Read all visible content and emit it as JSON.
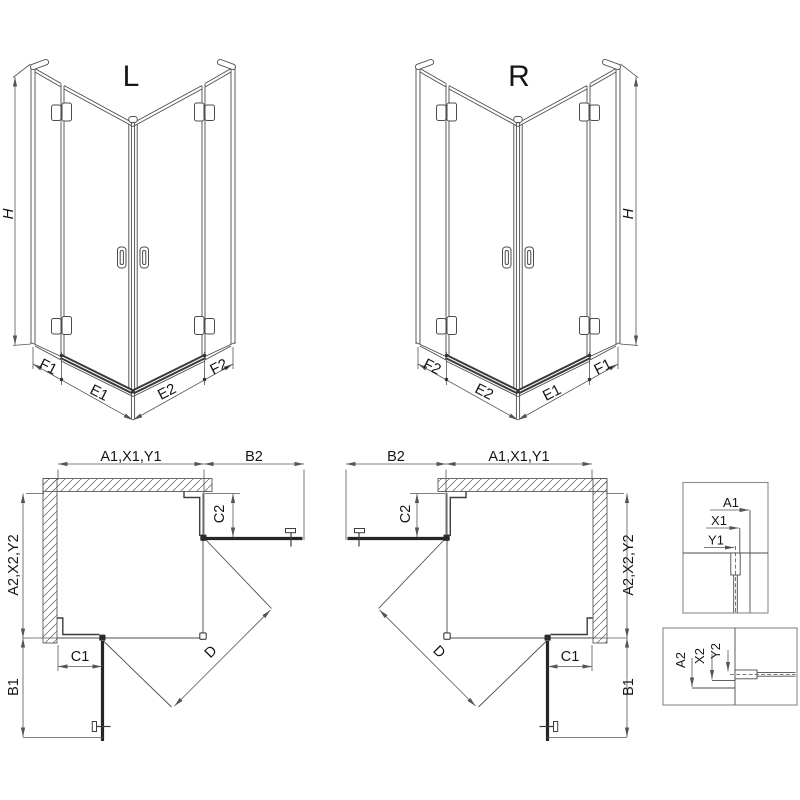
{
  "diagram": {
    "type": "technical-drawing",
    "subject": "corner shower enclosure, left (L) and right (R) hand versions",
    "views": {
      "iso_left": {
        "title": "L",
        "height": "H",
        "base_segments": [
          "F1",
          "E1",
          "E2",
          "F2"
        ]
      },
      "iso_right": {
        "title": "R",
        "height": "H",
        "base_segments": [
          "F2",
          "E2",
          "E1",
          "F1"
        ]
      },
      "plan_left": {
        "top_width": "A1,X1,Y1",
        "door_top": "B2",
        "side_depth": "A2,X2,Y2",
        "door_side": "B1",
        "fixed_bottom": "C1",
        "fixed_right": "C2",
        "diagonal": "D"
      },
      "plan_right": {
        "door_top": "B2",
        "top_width": "A1,X1,Y1",
        "side_depth": "A2,X2,Y2",
        "door_side": "B1",
        "fixed_bottom": "C1",
        "fixed_left": "C2",
        "diagonal": "D"
      },
      "detail_top": {
        "dims": [
          "A1",
          "X1",
          "Y1"
        ]
      },
      "detail_bottom": {
        "dims": [
          "A2",
          "X2",
          "Y2"
        ]
      }
    },
    "colors": {
      "line": "#4c4c4c",
      "profile_line": "#3c3c3c",
      "door_line": "#262626",
      "dim_line": "#555555",
      "text": "#161616",
      "hatch": "#777777",
      "background": "#ffffff"
    }
  }
}
